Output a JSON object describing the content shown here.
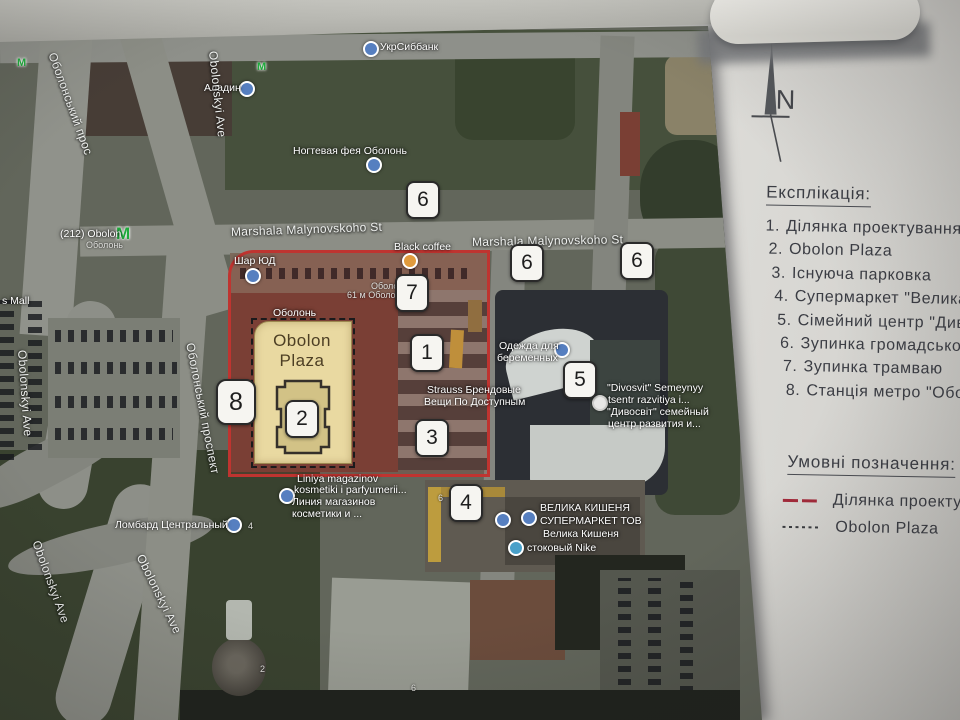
{
  "legend": {
    "explication_title": "Експлікація:",
    "items": [
      {
        "num": "1.",
        "label": "Ділянка проектування"
      },
      {
        "num": "2.",
        "label": "Obolon Plaza"
      },
      {
        "num": "3.",
        "label": "Існуюча парковка"
      },
      {
        "num": "4.",
        "label": "Супермаркет \"Велика киш"
      },
      {
        "num": "5.",
        "label": "Сімейний центр \"Дивосвіт"
      },
      {
        "num": "6.",
        "label": "Зупинка громадського т"
      },
      {
        "num": "7.",
        "label": "Зупинка трамваю"
      },
      {
        "num": "8.",
        "label": "Станція метро \"Оболонь"
      }
    ],
    "symbols_title": "Умовні позначення:",
    "symbols": [
      {
        "swatch": "red-solid-line",
        "label": "Ділянка проектуван"
      },
      {
        "swatch": "black-dotted-line",
        "label": "Obolon Plaza"
      }
    ],
    "north_label": "N"
  },
  "site": {
    "building_label_line1": "Obolon",
    "building_label_line2": "Plaza"
  },
  "markers": [
    {
      "number": "6",
      "x": 423,
      "y": 200
    },
    {
      "number": "6",
      "x": 527,
      "y": 263
    },
    {
      "number": "6",
      "x": 637,
      "y": 261
    },
    {
      "number": "7",
      "x": 412,
      "y": 293
    },
    {
      "number": "1",
      "x": 427,
      "y": 353
    },
    {
      "number": "2",
      "x": 302,
      "y": 419
    },
    {
      "number": "3",
      "x": 432,
      "y": 438
    },
    {
      "number": "5",
      "x": 580,
      "y": 380
    },
    {
      "number": "4",
      "x": 466,
      "y": 503
    },
    {
      "number": "8",
      "x": 236,
      "y": 402,
      "large": true
    }
  ],
  "map_labels": [
    {
      "text": "УкрСиббанк",
      "x": 380,
      "y": 41,
      "s": "poi"
    },
    {
      "text": "Аладин",
      "x": 204,
      "y": 82,
      "s": "poi"
    },
    {
      "text": "Ногтевая фея Оболонь",
      "x": 293,
      "y": 145,
      "s": "poi"
    },
    {
      "text": "Marshala Malynovskoho St",
      "x": 231,
      "y": 225,
      "s": "street",
      "rot": -2
    },
    {
      "text": "Marshala Malynovskoho St",
      "x": 472,
      "y": 235,
      "s": "street",
      "rot": -1
    },
    {
      "text": "Black coffee",
      "x": 394,
      "y": 241,
      "s": "poi"
    },
    {
      "text": "Шар ЮД",
      "x": 234,
      "y": 255,
      "s": "poi"
    },
    {
      "text": "Оболонь",
      "x": 273,
      "y": 307,
      "s": "poi"
    },
    {
      "text": "Оболо",
      "x": 371,
      "y": 281,
      "s": "small"
    },
    {
      "text": "61 м  Оболонь",
      "x": 347,
      "y": 290,
      "s": "small"
    },
    {
      "text": "Strauss Брендовые",
      "x": 427,
      "y": 384,
      "s": "poi"
    },
    {
      "text": "Вещи По Доступным",
      "x": 424,
      "y": 396,
      "s": "poi"
    },
    {
      "text": "Одежда для",
      "x": 499,
      "y": 340,
      "s": "poi"
    },
    {
      "text": "беременных",
      "x": 497,
      "y": 352,
      "s": "poi"
    },
    {
      "text": "\"Divosvit\" Semeynyy",
      "x": 607,
      "y": 382,
      "s": "poi"
    },
    {
      "text": "tsentr razvitiya i...",
      "x": 608,
      "y": 394,
      "s": "poi"
    },
    {
      "text": "\"Дивосвіт\" семейный",
      "x": 607,
      "y": 406,
      "s": "poi"
    },
    {
      "text": "центр развития и...",
      "x": 608,
      "y": 418,
      "s": "poi"
    },
    {
      "text": "Liniya magazinov",
      "x": 297,
      "y": 473,
      "s": "poi"
    },
    {
      "text": "kosmetiki i parfyumerii...",
      "x": 294,
      "y": 484,
      "s": "poi"
    },
    {
      "text": "Линия магазинов",
      "x": 292,
      "y": 496,
      "s": "poi"
    },
    {
      "text": "косметики и ...",
      "x": 292,
      "y": 508,
      "s": "poi"
    },
    {
      "text": "ВЕЛИКА КИШЕНЯ",
      "x": 540,
      "y": 502,
      "s": "poi"
    },
    {
      "text": "СУПЕРМАРКЕТ ТОВ",
      "x": 540,
      "y": 515,
      "s": "poi"
    },
    {
      "text": "Велика Кишеня",
      "x": 543,
      "y": 528,
      "s": "poi"
    },
    {
      "text": "стоковый Nike",
      "x": 527,
      "y": 542,
      "s": "poi"
    },
    {
      "text": "Ломбард Центральный",
      "x": 115,
      "y": 519,
      "s": "poi"
    },
    {
      "text": "s Mall",
      "x": 2,
      "y": 295,
      "s": "poi"
    },
    {
      "text": "(212) Obolon",
      "x": 60,
      "y": 228,
      "s": "poi"
    },
    {
      "text": "Оболонь",
      "x": 86,
      "y": 240,
      "s": "small"
    },
    {
      "text": "Obolonskyi Ave",
      "x": 213,
      "y": 44,
      "s": "street",
      "rot": 84
    },
    {
      "text": "Оболонський прос",
      "x": 52,
      "y": 46,
      "s": "street",
      "rot": 70
    },
    {
      "text": "Obolonskyi Ave",
      "x": 22,
      "y": 343,
      "s": "street",
      "rot": 86
    },
    {
      "text": "Оболонський проспект",
      "x": 190,
      "y": 336,
      "s": "street",
      "rot": 79
    },
    {
      "text": "Obolonskyi Ave",
      "x": 36,
      "y": 534,
      "s": "street",
      "rot": 70
    },
    {
      "text": "Obolonskyi Ave",
      "x": 140,
      "y": 548,
      "s": "street",
      "rot": 64
    },
    {
      "text": "2",
      "x": 260,
      "y": 664,
      "s": "small"
    },
    {
      "text": "6",
      "x": 411,
      "y": 683,
      "s": "small"
    },
    {
      "text": "4",
      "x": 248,
      "y": 521,
      "s": "small"
    },
    {
      "text": "6",
      "x": 438,
      "y": 493,
      "s": "small"
    }
  ],
  "map_icons": [
    {
      "t": "blue",
      "x": 363,
      "y": 41
    },
    {
      "t": "blue",
      "x": 239,
      "y": 81
    },
    {
      "t": "blue",
      "x": 366,
      "y": 157
    },
    {
      "t": "orange",
      "x": 402,
      "y": 253
    },
    {
      "t": "blue",
      "x": 245,
      "y": 268
    },
    {
      "t": "blue",
      "x": 554,
      "y": 342
    },
    {
      "t": "white",
      "x": 592,
      "y": 395
    },
    {
      "t": "blue",
      "x": 279,
      "y": 488
    },
    {
      "t": "blue",
      "x": 495,
      "y": 512
    },
    {
      "t": "blue",
      "x": 521,
      "y": 510
    },
    {
      "t": "teal",
      "x": 508,
      "y": 540
    },
    {
      "t": "blue",
      "x": 226,
      "y": 517
    },
    {
      "t": "metro",
      "x": 116,
      "y": 224,
      "glyph": "М"
    },
    {
      "t": "metro-sm",
      "x": 257,
      "y": 61,
      "glyph": "М"
    },
    {
      "t": "metro-sm",
      "x": 17,
      "y": 57,
      "glyph": "М"
    }
  ],
  "colors": {
    "site_outline_red": "#bf3430",
    "plaza_fill_yellow": "#e9d9a1",
    "marker_border": "#2a2a2a",
    "paper": "#e6e5e1",
    "legend_ink": "#3b3d44",
    "legend_red_line": "#a32a3a",
    "metro_green": "#1faa3c"
  }
}
